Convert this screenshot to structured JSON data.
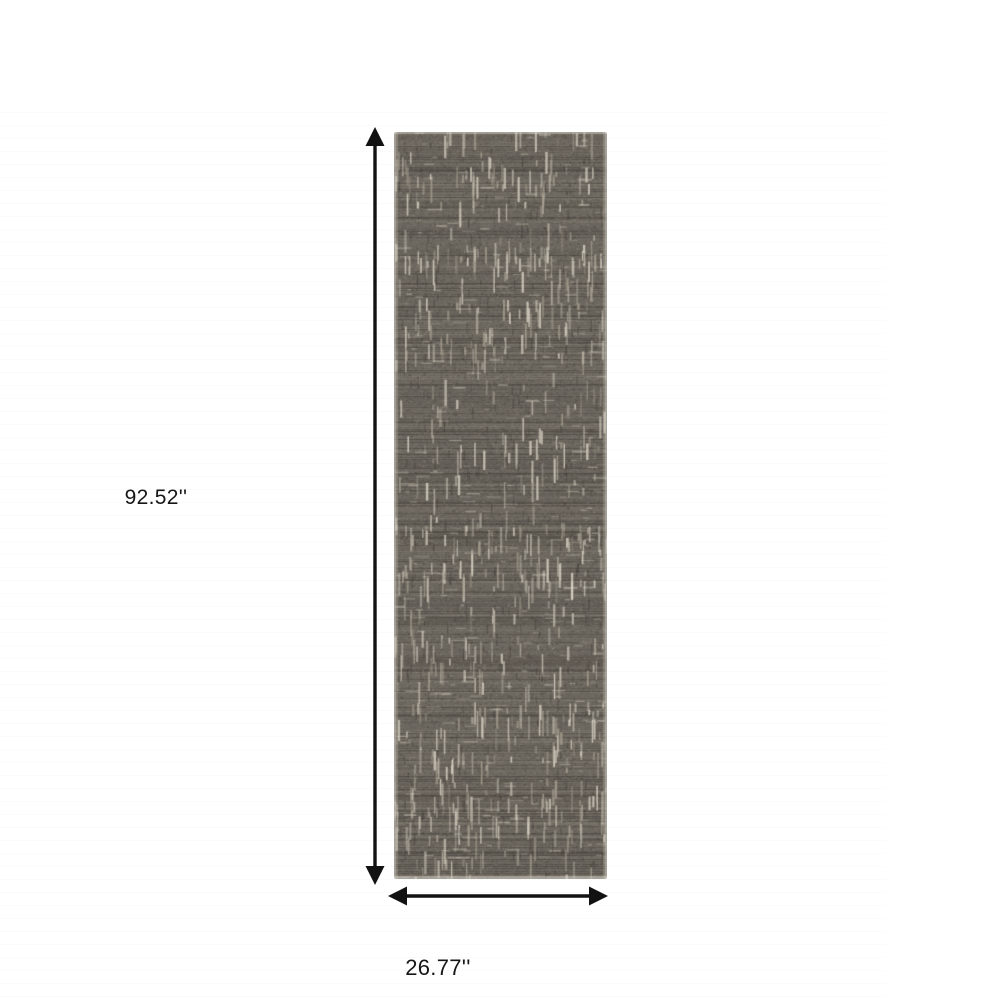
{
  "diagram": {
    "height_label": "92.52''",
    "width_label": "26.77''",
    "arrow_color": "#121212",
    "label_color": "#161616",
    "rug": {
      "base_color": "#6c675f",
      "dark_stria_color": "#3e3a34",
      "light_stria_color": "#948d80",
      "light_fleck_color": "#dad3c5",
      "mid_fleck_color": "#aaa293",
      "edge_color": "#d9d4c8"
    }
  }
}
